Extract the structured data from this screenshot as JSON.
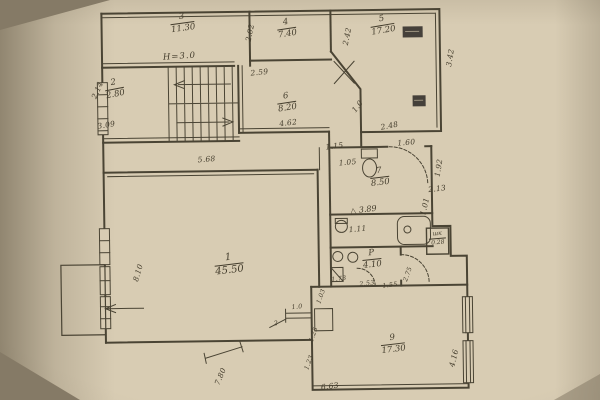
{
  "plan": {
    "height_note": "H=3.0",
    "colors": {
      "paper": "#d8ccb3",
      "ink": "#433c2c"
    },
    "rooms": {
      "room1": {
        "num": "1",
        "area": "45.50"
      },
      "room2": {
        "num": "2",
        "area": "2.80"
      },
      "room3": {
        "num": "3",
        "area": "11.30"
      },
      "room4": {
        "num": "4",
        "area": "7.40"
      },
      "room5": {
        "num": "5",
        "area": "17.20"
      },
      "room6": {
        "num": "6",
        "area": "8.20"
      },
      "room7": {
        "num": "7",
        "area": "8.50"
      },
      "room8": {
        "glyph": "△",
        "area": "3.89"
      },
      "roomP": {
        "num": "Р",
        "area": "4.10"
      },
      "closet": {
        "num": "шк",
        "area": "0.28"
      },
      "room9": {
        "num": "9",
        "area": "17.30"
      }
    },
    "dims": {
      "d202": "2.02",
      "d242": "2.42",
      "d342": "3.42",
      "d259": "2.59",
      "d462": "4.62",
      "d309": "3.09",
      "d214": "2.14",
      "d568": "5.68",
      "d248": "2.48",
      "d160": "1.60",
      "d115": "1.15",
      "d105": "1.05",
      "d192": "1.92",
      "d213": "2.13",
      "d101": "1.01",
      "d111": "1.11",
      "d253": "2.53",
      "d155": "1.55",
      "d275": "2.75",
      "d173": "1.73",
      "d103": "1.03",
      "d125": "1.25",
      "d123": "1.23",
      "d10": "1.0",
      "d10b": "1.0",
      "d2": "2",
      "d810": "8.10",
      "d780": "7.80",
      "d663": "6.63",
      "d416": "4.16"
    }
  }
}
